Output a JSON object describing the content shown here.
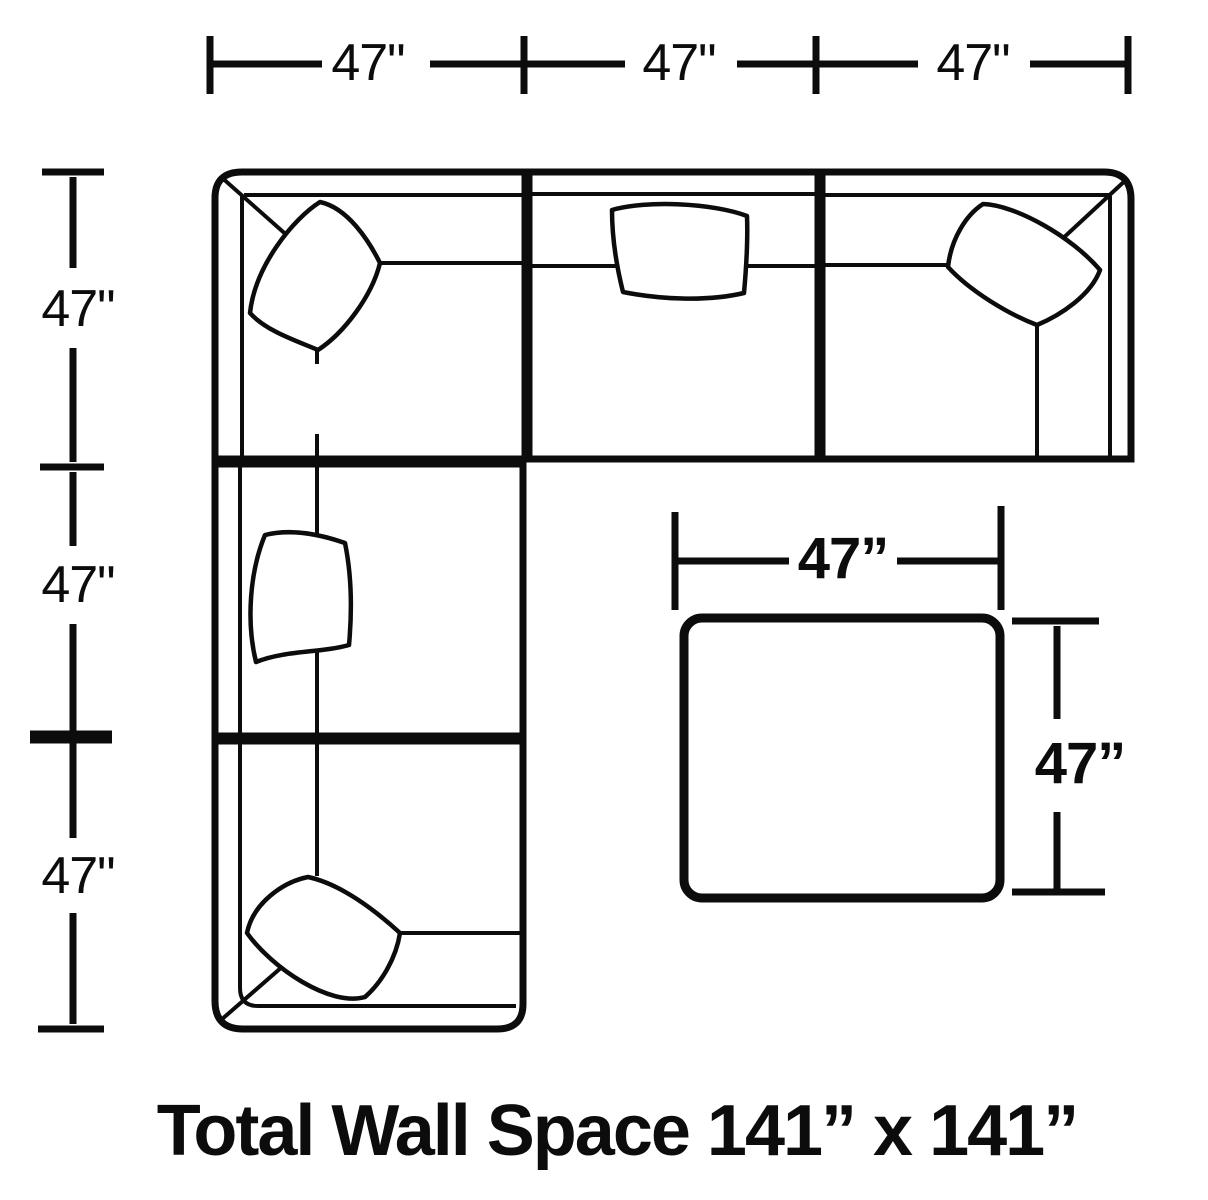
{
  "colors": {
    "ink": "#0c0c0c",
    "background": "#ffffff"
  },
  "rulers": {
    "top": {
      "labels": [
        "47\"",
        "47\"",
        "47\""
      ]
    },
    "left": {
      "labels": [
        "47\"",
        "47\"",
        "47\""
      ]
    }
  },
  "ottoman": {
    "width_label": "47”",
    "height_label": "47”"
  },
  "footer": {
    "title": "Total Wall Space 141” x 141”"
  }
}
